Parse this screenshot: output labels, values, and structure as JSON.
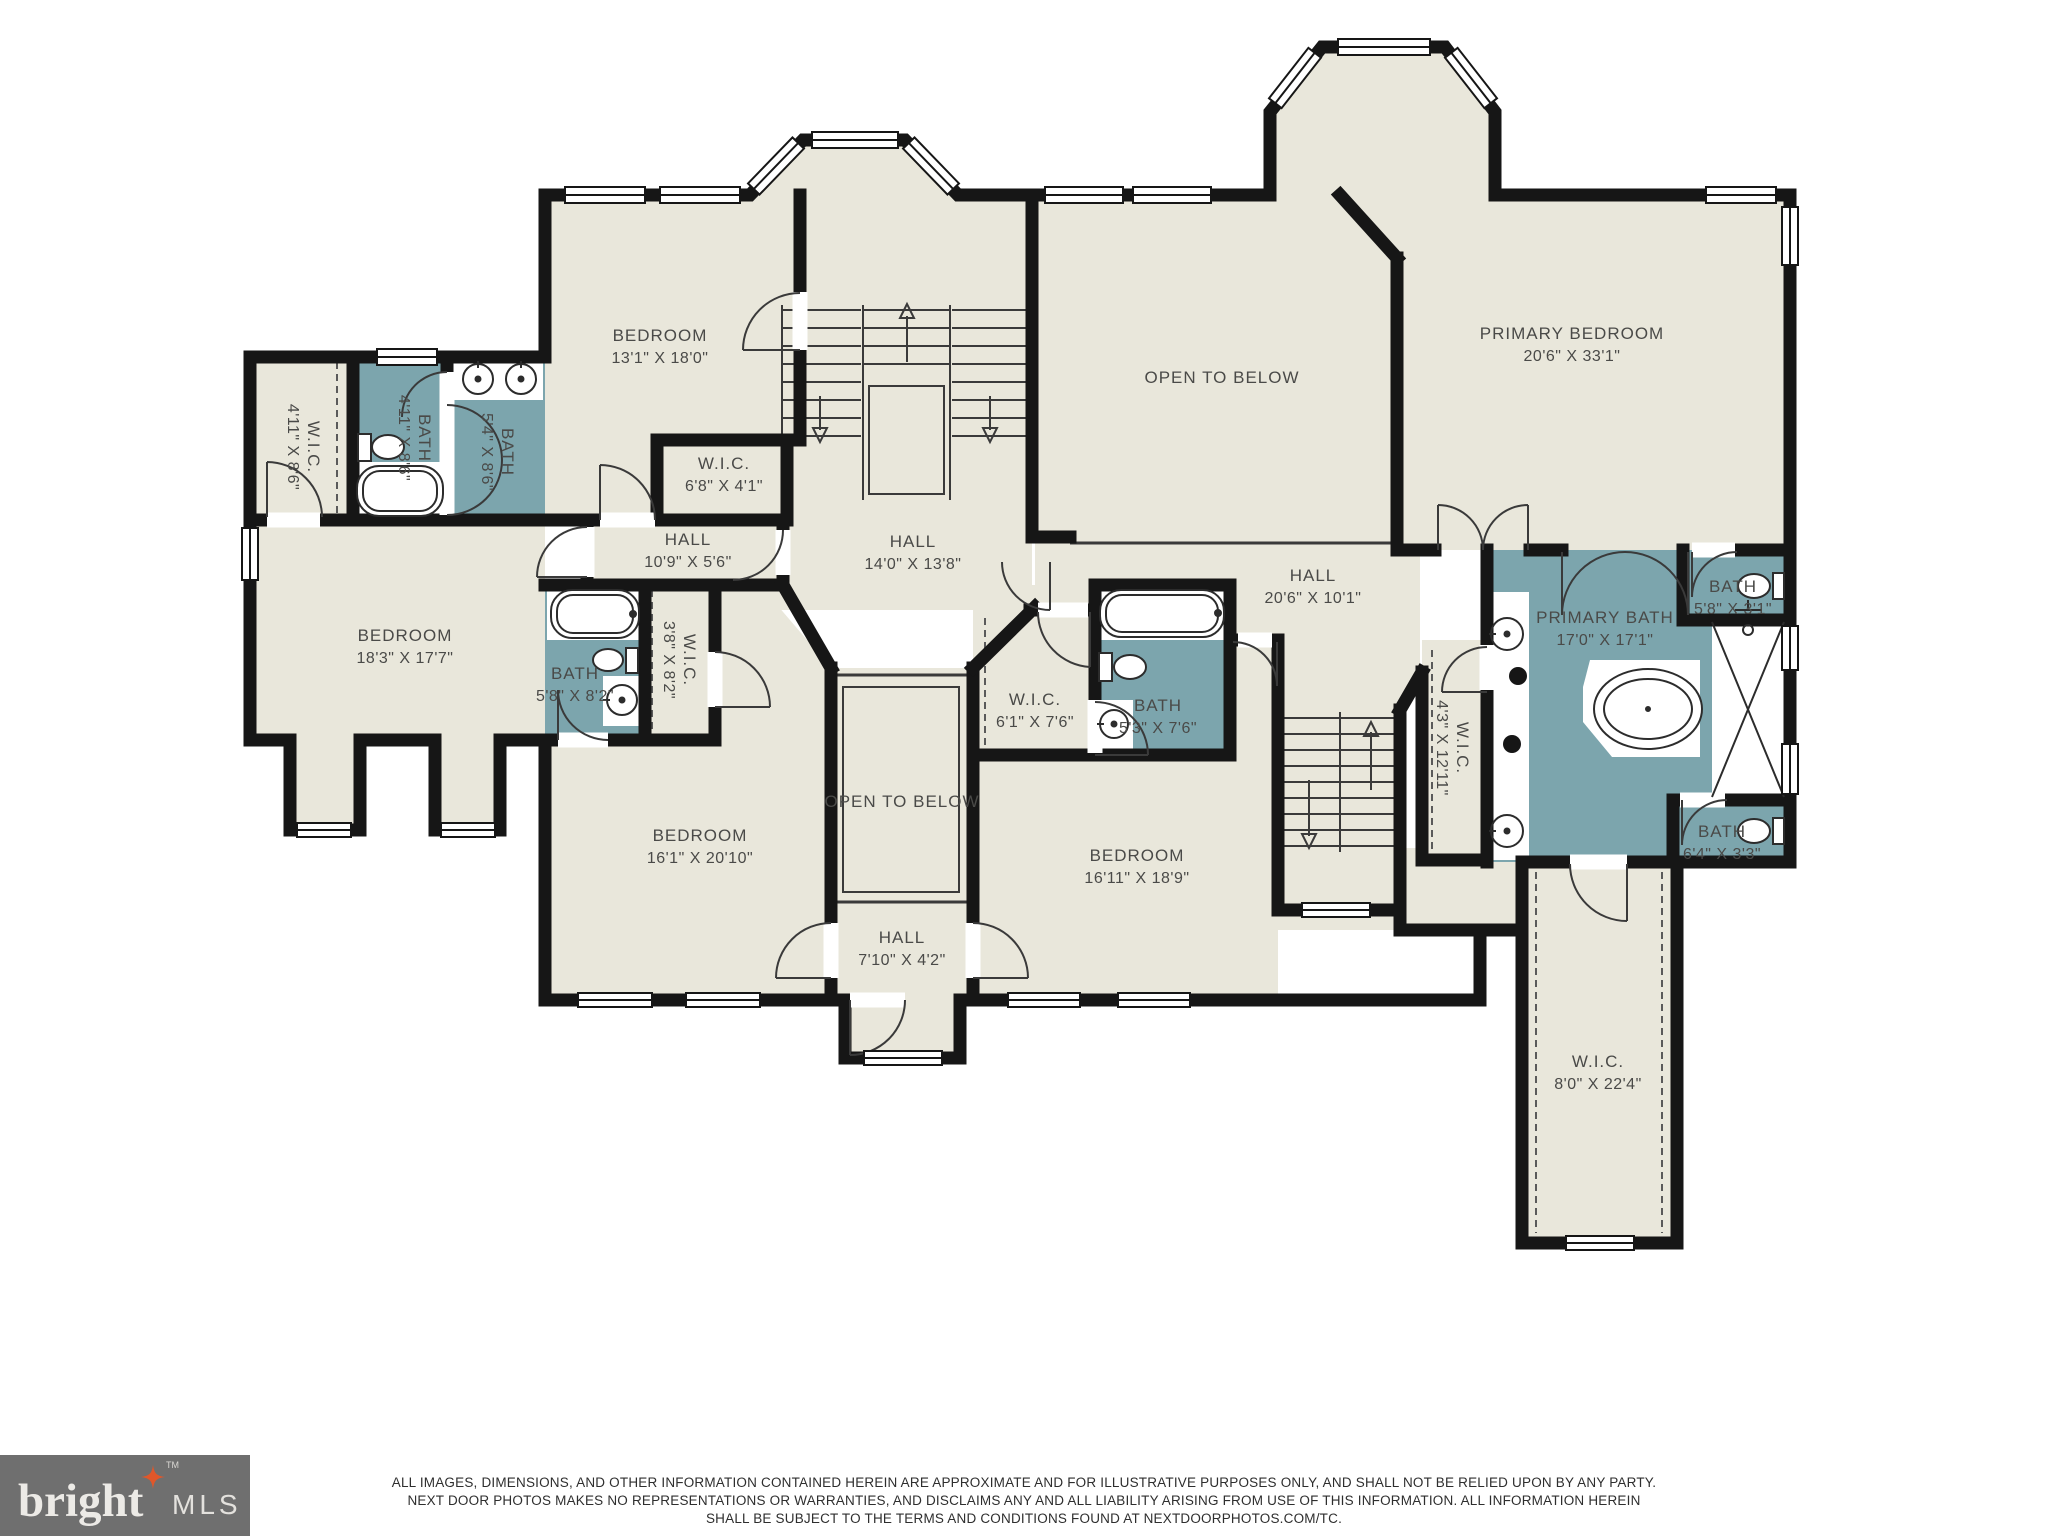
{
  "palette": {
    "room_fill": "#e9e7db",
    "bath_fill": "#7ca5ad",
    "wall": "#161616",
    "label": "#4a4a48",
    "logo_bg": "#6f6f6f",
    "logo_text": "#eceae6",
    "logo_star": "#e0572a"
  },
  "rooms": [
    {
      "name": "BEDROOM",
      "dims": "13'1\" X 18'0\""
    },
    {
      "name": "W.I.C.",
      "dims": "6'8\" X 4'1\""
    },
    {
      "name": "HALL",
      "dims": "10'9\" X 5'6\""
    },
    {
      "name": "HALL",
      "dims": "14'0\" X 13'8\""
    },
    {
      "name": "OPEN TO BELOW",
      "dims": ""
    },
    {
      "name": "PRIMARY BEDROOM",
      "dims": "20'6\" X 33'1\""
    },
    {
      "name": "W.I.C.",
      "dims": "4'11\" X 8'6\""
    },
    {
      "name": "BATH",
      "dims": "4'11\" X 8'6\""
    },
    {
      "name": "BATH",
      "dims": "5'4\" X 8'6\""
    },
    {
      "name": "BEDROOM",
      "dims": "18'3\" X 17'7\""
    },
    {
      "name": "BATH",
      "dims": "5'8\" X 8'2\""
    },
    {
      "name": "W.I.C.",
      "dims": "3'8\" X 8'2\""
    },
    {
      "name": "BEDROOM",
      "dims": "16'1\" X 20'10\""
    },
    {
      "name": "OPEN TO BELOW",
      "dims": ""
    },
    {
      "name": "HALL",
      "dims": "7'10\" X 4'2\""
    },
    {
      "name": "W.I.C.",
      "dims": "6'1\" X 7'6\""
    },
    {
      "name": "BATH",
      "dims": "5'3\" X 7'6\""
    },
    {
      "name": "BEDROOM",
      "dims": "16'11\" X 18'9\""
    },
    {
      "name": "HALL",
      "dims": "20'6\" X 10'1\""
    },
    {
      "name": "W.I.C.",
      "dims": "4'3\" X 12'11\""
    },
    {
      "name": "PRIMARY BATH",
      "dims": "17'0\" X 17'1\""
    },
    {
      "name": "BATH",
      "dims": "5'8\" X 3'1\""
    },
    {
      "name": "BATH",
      "dims": "6'4\" X 3'3\""
    },
    {
      "name": "W.I.C.",
      "dims": "8'0\" X 22'4\""
    }
  ],
  "footer": {
    "disclaimer_lines": [
      "ALL IMAGES, DIMENSIONS, AND OTHER INFORMATION CONTAINED HEREIN ARE APPROXIMATE AND FOR ILLUSTRATIVE PURPOSES ONLY, AND SHALL NOT BE RELIED UPON BY ANY PARTY.",
      "NEXT DOOR PHOTOS MAKES NO REPRESENTATIONS OR WARRANTIES, AND DISCLAIMS ANY AND ALL LIABILITY ARISING FROM USE OF THIS INFORMATION. ALL INFORMATION HEREIN",
      "SHALL BE SUBJECT TO THE TERMS AND CONDITIONS FOUND AT NEXTDOORPHOTOS.COM/TC."
    ],
    "logo": {
      "brand": "bright",
      "suffix": "MLS",
      "tm": "TM"
    }
  }
}
